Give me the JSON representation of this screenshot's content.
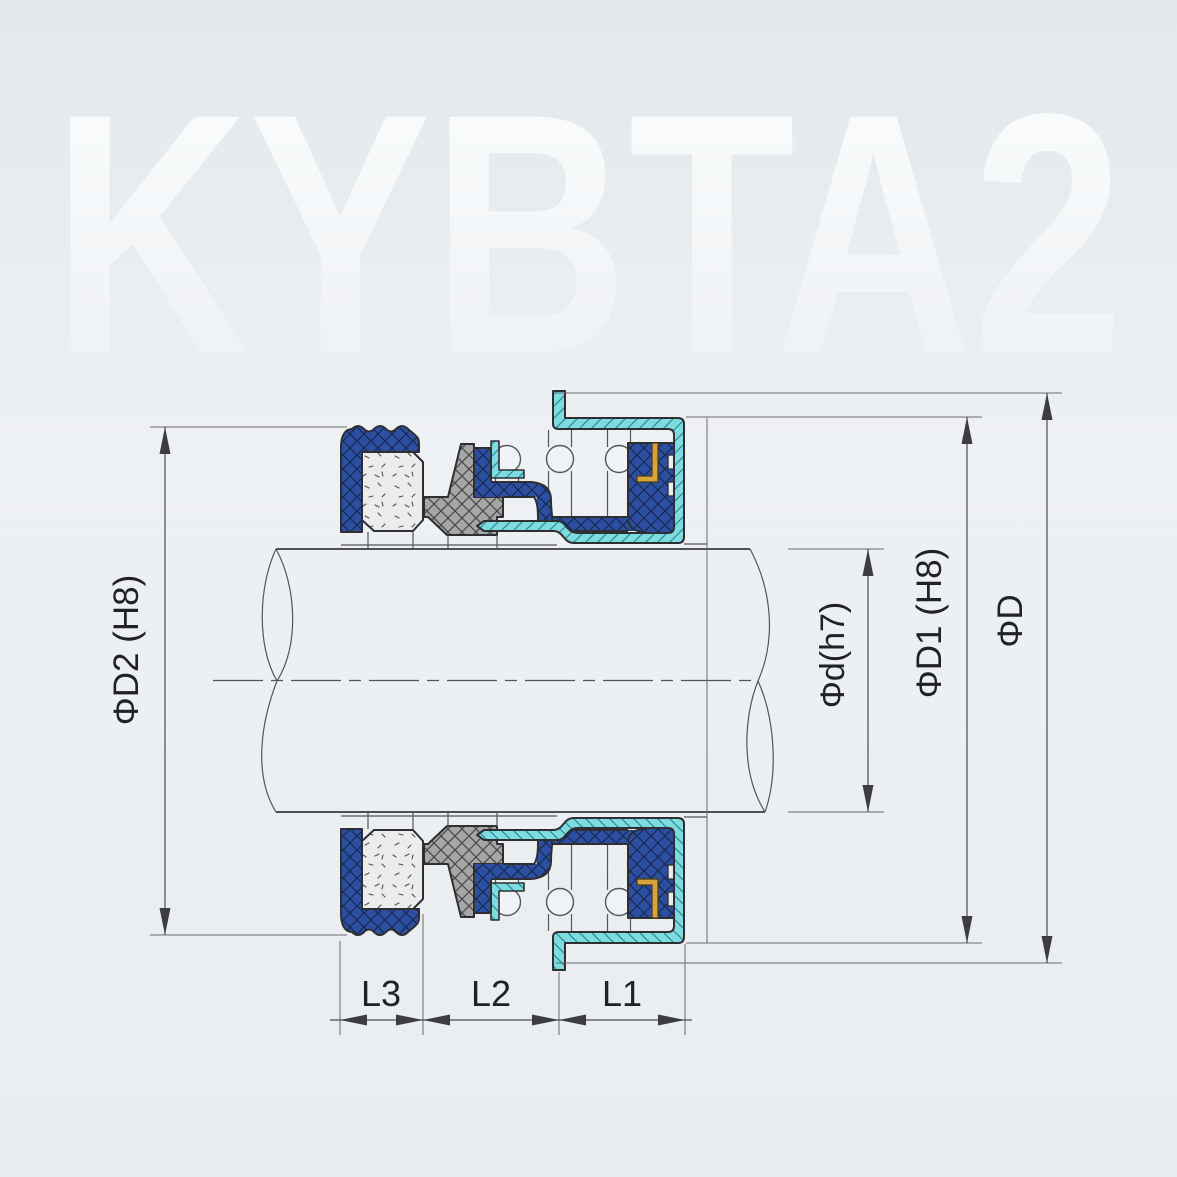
{
  "watermark": "KYBTA2",
  "dimensions": {
    "d2_label": "ΦD2 (H8)",
    "d_label": "Φd(h7)",
    "d1_label": "ΦD1 (H8)",
    "D_label": "ΦD",
    "l1_label": "L1",
    "l2_label": "L2",
    "l3_label": "L3"
  },
  "colors": {
    "bg_top": "#e3e8eb",
    "bg_mid": "#eef1f3",
    "bg_low": "#e8edf0",
    "blue": "#2b50a1",
    "blue_hatch": "#1a2a55",
    "cyan": "#7edce0",
    "cyan_hatch": "#2b8f96",
    "gray": "#a6a6a6",
    "gray_hatch": "#474747",
    "ceramic": "#ececec",
    "speckle": "#55504a",
    "gold": "#d8a33c",
    "gold_edge": "#4a3a14",
    "outline": "#2f2f33",
    "thin": "#55555a",
    "dim": "#4c4c50",
    "text": "#222226",
    "watermark_top": "#fbfdfe",
    "watermark_bottom": "#edf0f3",
    "spring": "#f0f3f5"
  }
}
